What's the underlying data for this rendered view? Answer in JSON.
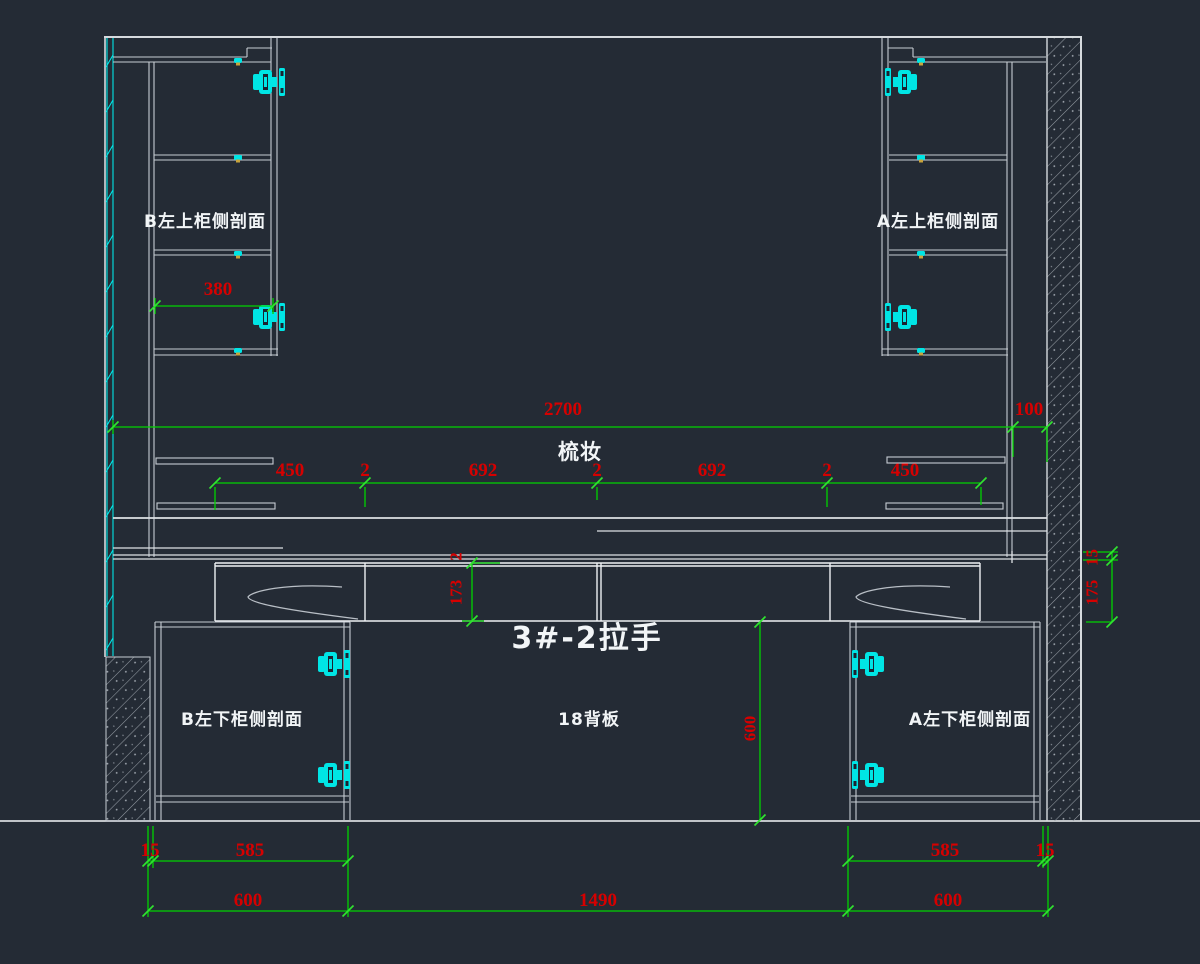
{
  "drawing": {
    "labels": {
      "cab_top_left": "B左上柜侧剖面",
      "cab_top_right": "A左上柜侧剖面",
      "cab_bottom_left": "B左下柜侧剖面",
      "cab_bottom_right": "A左下柜侧剖面",
      "back_panel": "18背板",
      "vanity": "梳妆",
      "handle": "3#-2拉手"
    },
    "dims": {
      "upper_shelf_depth": "380",
      "counter_width": "2700",
      "wall_gap": "100",
      "chain": [
        "450",
        "2",
        "692",
        "2",
        "692",
        "2",
        "450"
      ],
      "drawer_gap": "2",
      "drawer_height": "173",
      "counter_thickness": "15",
      "drawer_band_height": "175",
      "back_panel_height": "600",
      "plinth_left": [
        "15",
        "585"
      ],
      "plinth_right": [
        "585",
        "15"
      ],
      "base_widths": [
        "600",
        "1490",
        "600"
      ]
    },
    "colors": {
      "background": "#242b35",
      "linework": "#c6ccd3",
      "dimension_text": "#d60000",
      "dimension_line": "#00d400",
      "hardware": "#00e5e5"
    }
  }
}
